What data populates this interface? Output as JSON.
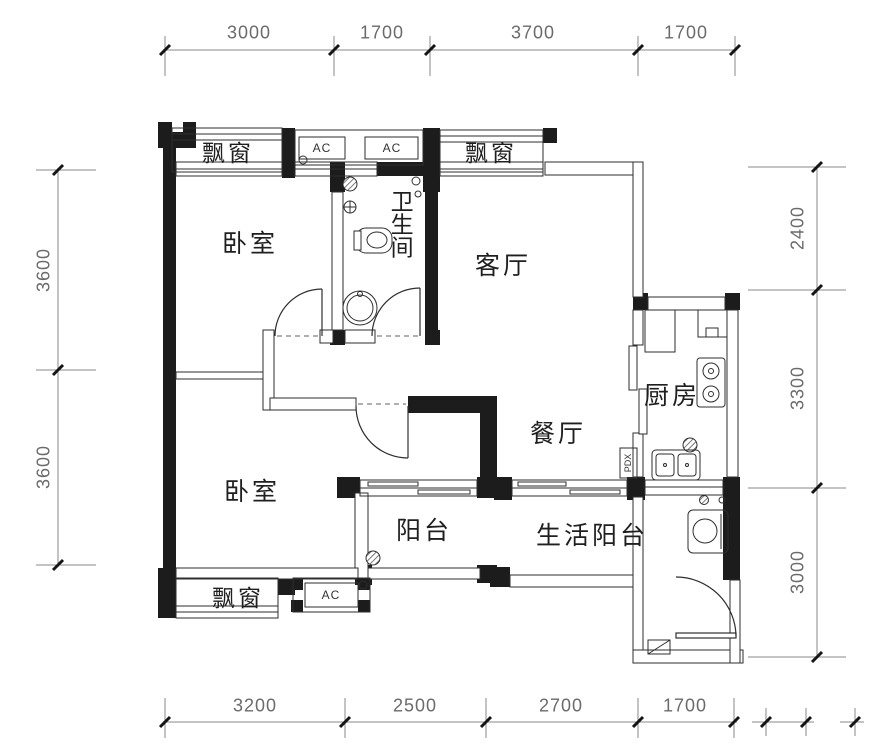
{
  "plan": {
    "title": "two-bedroom apartment floor plan",
    "rooms": {
      "bedroom_top": "卧室",
      "bathroom": "卫生间",
      "living": "客厅",
      "kitchen": "厨房",
      "dining": "餐厅",
      "bedroom_bottom": "卧室",
      "balcony": "阳台",
      "life_balcony": "生活阳台"
    },
    "features": {
      "bay_window_top_left": "飘窗",
      "bay_window_top_right": "飘窗",
      "bay_window_bottom": "飘窗",
      "ac_top_left": "AC",
      "ac_top_right": "AC",
      "ac_bottom": "AC",
      "duct": "PDX"
    },
    "dimensions": {
      "top": [
        "3000",
        "1700",
        "3700",
        "1700"
      ],
      "bottom": [
        "3200",
        "2500",
        "2700",
        "1700"
      ],
      "left": [
        "3600",
        "3600"
      ],
      "right": [
        "2400",
        "3300",
        "3000"
      ]
    },
    "colors": {
      "wall_fill": "#1c1c1c",
      "wall_line": "#2e2e2e",
      "dim_line": "#8a8a8a",
      "dim_text": "#6b6b6b",
      "background": "#ffffff"
    }
  }
}
